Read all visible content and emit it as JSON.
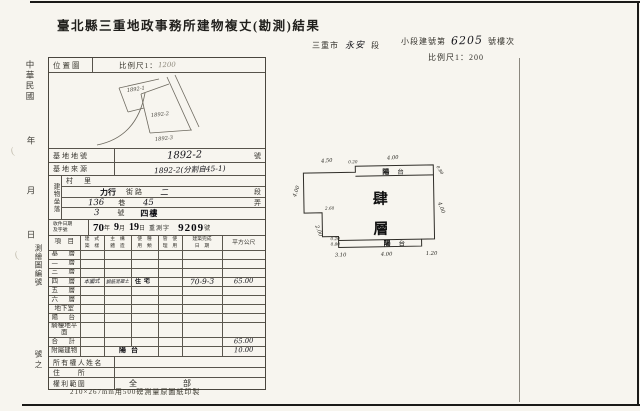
{
  "page": {
    "title": "臺北縣三重地政事務所建物複丈(勘測)結果",
    "footnote": "210×267mm用500磅測量原圖紙印製"
  },
  "margin": {
    "era": "中華民國",
    "year": "年",
    "month": "月",
    "day": "日",
    "map_no": "測繪圖編號",
    "no_suffix": "號之"
  },
  "header": {
    "city": "三重市",
    "section": "永安",
    "section_unit": "段",
    "bno_prefix": "小段建號第",
    "bno": "6205",
    "bno_suffix": "號樓次",
    "scale": "比例尺1：200"
  },
  "location_map": {
    "label": "位置圖",
    "scale_prefix": "比例尺1：",
    "scale_value": "1200",
    "parcel_1": "1892-1",
    "parcel_2": "1892-2",
    "parcel_3": "1892-3"
  },
  "fields": {
    "lot_label": "基地地號",
    "lot_value": "1892-2",
    "lot_unit": "號",
    "source_label": "基地來源",
    "source_value": "1892-2(分割自45-1)",
    "situs_label": "建物坐落",
    "village_label": "村　里",
    "street_value": "力行",
    "street_label": "街路",
    "street_sec_value": "二",
    "street_sec_label": "段",
    "lane_value": "136",
    "lane_label": "巷",
    "alley_value": "45",
    "alley_label": "弄",
    "door_value": "3",
    "door_label": "號",
    "floor_value": "四樓",
    "receipt_label_1": "收件日期",
    "receipt_label_2": "及字號",
    "receipt_year": "70",
    "receipt_year_unit": "年",
    "receipt_month": "9",
    "receipt_month_unit": "月",
    "receipt_day": "19",
    "receipt_day_unit": "日",
    "receipt_word": "重測字",
    "receipt_no": "9209",
    "receipt_no_unit": "號"
  },
  "floor_table": {
    "h_item": "項　目",
    "h_style_1": "建　式",
    "h_style_2": "築　樣",
    "h_struct_1": "主　構",
    "h_struct_2": "體　造",
    "h_use_1": "使　種",
    "h_use_2": "用　類",
    "h_manage_1": "管　使",
    "h_manage_2": "理　用",
    "h_date_1": "建築完成",
    "h_date_2": "日　期",
    "h_area": "平方公尺",
    "rows": [
      {
        "label": "基　層",
        "style": "",
        "struct": "",
        "use": "",
        "manage": "",
        "date": "",
        "area": ""
      },
      {
        "label": "二　層",
        "style": "",
        "struct": "",
        "use": "",
        "manage": "",
        "date": "",
        "area": ""
      },
      {
        "label": "三　層",
        "style": "",
        "struct": "",
        "use": "",
        "manage": "",
        "date": "",
        "area": ""
      },
      {
        "label": "四　層",
        "style": "本國式",
        "struct": "鋼筋混凝土",
        "use": "住宅",
        "manage": "",
        "date": "70-9-3",
        "area": "65.00"
      },
      {
        "label": "五　層",
        "style": "",
        "struct": "",
        "use": "",
        "manage": "",
        "date": "",
        "area": ""
      },
      {
        "label": "六　層",
        "style": "",
        "struct": "",
        "use": "",
        "manage": "",
        "date": "",
        "area": ""
      },
      {
        "label": "地下室",
        "style": "",
        "struct": "",
        "use": "",
        "manage": "",
        "date": "",
        "area": ""
      },
      {
        "label": "陽　台",
        "style": "",
        "struct": "",
        "use": "",
        "manage": "",
        "date": "",
        "area": ""
      },
      {
        "label": "騎樓地平面",
        "style": "",
        "struct": "",
        "use": "",
        "manage": "",
        "date": "",
        "area": ""
      },
      {
        "label": "合　計",
        "style": "",
        "struct": "",
        "use": "",
        "manage": "",
        "date": "",
        "area": "65.00"
      },
      {
        "label": "附屬建物",
        "style": "",
        "struct": "",
        "use": "陽台",
        "manage": "",
        "date": "",
        "area": "10.00"
      }
    ],
    "owner_label": "所有權人姓名",
    "addr_label": "住　　所",
    "rights_label": "權利範圍",
    "rights_value": "全　　部"
  },
  "plan": {
    "floor_char_1": "肆",
    "floor_char_2": "層",
    "balcony_1a": "陽",
    "balcony_1b": "台",
    "balcony_2a": "陽",
    "balcony_2b": "台",
    "dims": {
      "top_left": "4.50",
      "top_step": "0.20",
      "top_balcony": "4.00",
      "right_top": "0.80",
      "right": "4.00",
      "bottom_right": "1.20",
      "bottom_balcony": "4.00",
      "bottom_step_a": "0.20",
      "bottom_step_b": "0.80",
      "bottom_left": "3.10",
      "left_lower": "2.00",
      "left_step": "2.60",
      "left_upper": "4.00"
    }
  }
}
